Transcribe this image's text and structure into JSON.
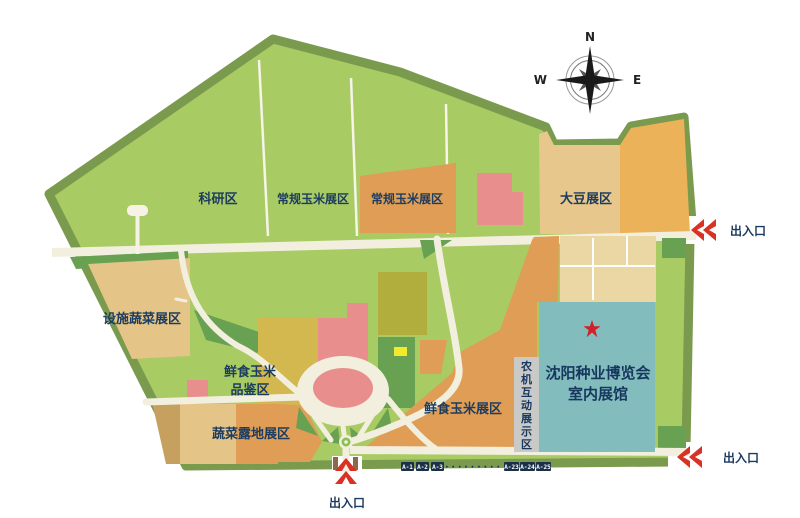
{
  "map_areas": {
    "research": {
      "label": "科研区"
    },
    "regular_corn_west": {
      "label": "常规玉米展区"
    },
    "regular_corn_east": {
      "label": "常规玉米展区"
    },
    "soybean": {
      "label": "大豆展区"
    },
    "facility_vegetable": {
      "label": "设施蔬菜展区"
    },
    "fresh_corn_tasting": {
      "line1": "鲜食玉米",
      "line2": "品鉴区"
    },
    "vegetable_open_field": {
      "label": "蔬菜露地展区"
    },
    "fresh_corn_exhibition": {
      "label": "鲜食玉米展区"
    },
    "agri_machinery_display": {
      "chars": [
        "农",
        "机",
        "互",
        "动",
        "展",
        "示",
        "区"
      ]
    },
    "indoor_hall": {
      "line1": "沈阳种业博览会",
      "line2": "室内展馆"
    }
  },
  "entrances": {
    "east": {
      "label": "出入口"
    },
    "southeast": {
      "label": "出入口"
    },
    "south": {
      "label": "出入口"
    }
  },
  "compass": {
    "north": "N",
    "west": "W",
    "east": "E"
  },
  "booth_badges": {
    "left": [
      "A-1",
      "A-2",
      "A-3"
    ],
    "dots": "·········",
    "right": [
      "A-23",
      "A-24",
      "A-25"
    ]
  },
  "colors": {
    "border_green": "#7a9a4e",
    "field_light_green": "#a9cb64",
    "field_medium_green": "#67a151",
    "plot_orange": "#df9d55",
    "plot_tan": "#e5c487",
    "plot_gold": "#d3b74f",
    "plot_olive": "#b1ae3d",
    "soybean_tan": "#e7c78b",
    "soybean_gold": "#ecb259",
    "building_pink": "#e88f8d",
    "hall_teal": "#82bcbd",
    "machinery_gray": "#c9c9c7",
    "road_cream": "#f3efdf",
    "label_navy": "#1c3c60",
    "entrance_red": "#da3125",
    "badge_navy": "#1a2f48",
    "highlight_yellow": "#f2ea2d",
    "star_red": "#cf2127"
  }
}
